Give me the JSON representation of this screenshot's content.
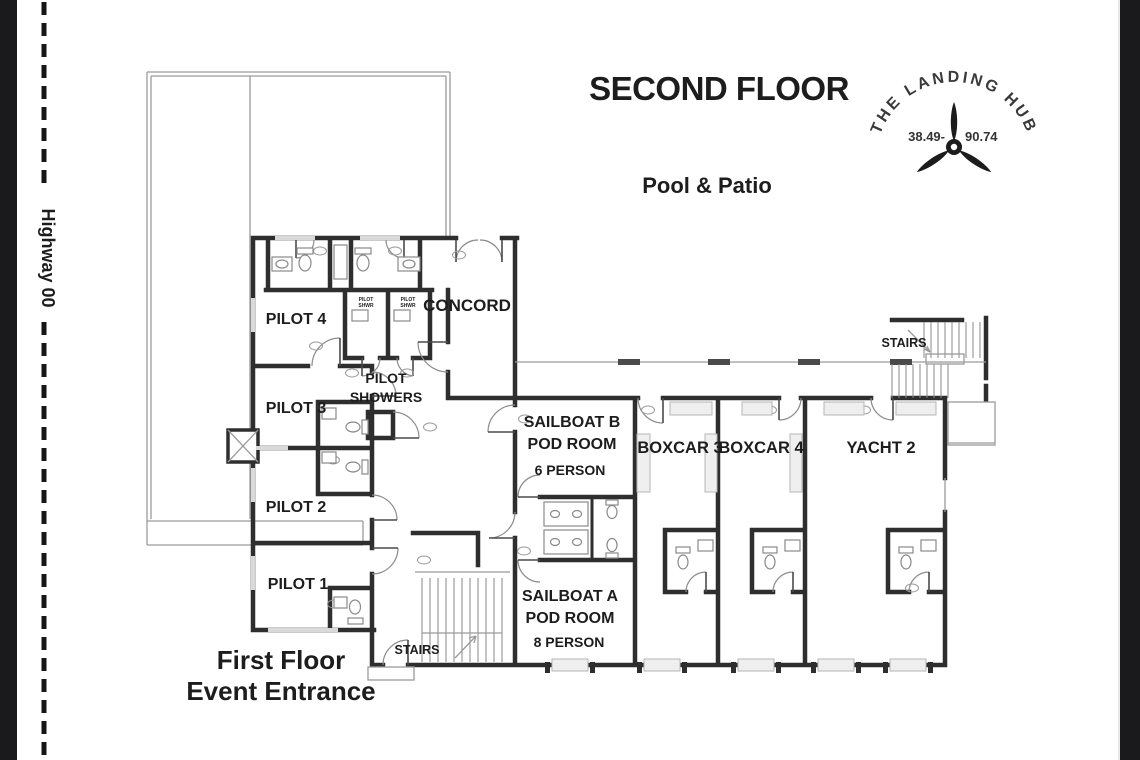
{
  "page": {
    "title": "SECOND FLOOR",
    "subtitle": "Pool & Patio",
    "highway_label": "Highway 00",
    "entrance_line1": "First Floor",
    "entrance_line2": "Event Entrance"
  },
  "logo": {
    "arc_text": "THE LANDING HUB",
    "left_number": "38.49-",
    "right_number": "90.74",
    "icon": "propeller-icon"
  },
  "rooms": {
    "pilot4": "PILOT 4",
    "pilot3": "PILOT 3",
    "pilot2": "PILOT 2",
    "pilot1": "PILOT 1",
    "concord": "CONCORD",
    "showers_line1": "PILOT",
    "showers_line2": "SHOWERS",
    "stall_line1": "PILOT",
    "stall_line2": "SHWR",
    "sailboat_b_name": "SAILBOAT B",
    "sailboat_b_type": "POD ROOM",
    "sailboat_b_capacity": "6 PERSON",
    "sailboat_a_name": "SAILBOAT A",
    "sailboat_a_type": "POD ROOM",
    "sailboat_a_capacity": "8 PERSON",
    "boxcar3": "BOXCAR 3",
    "boxcar4": "BOXCAR 4",
    "yacht2": "YACHT 2",
    "stairs_upper": "STAIRS",
    "stairs_lower": "STAIRS"
  },
  "colors": {
    "wall": "#2e2e2e",
    "thin_line": "#9b9b9b",
    "photo_edge": "#1a1a1c",
    "background": "#ffffff"
  }
}
